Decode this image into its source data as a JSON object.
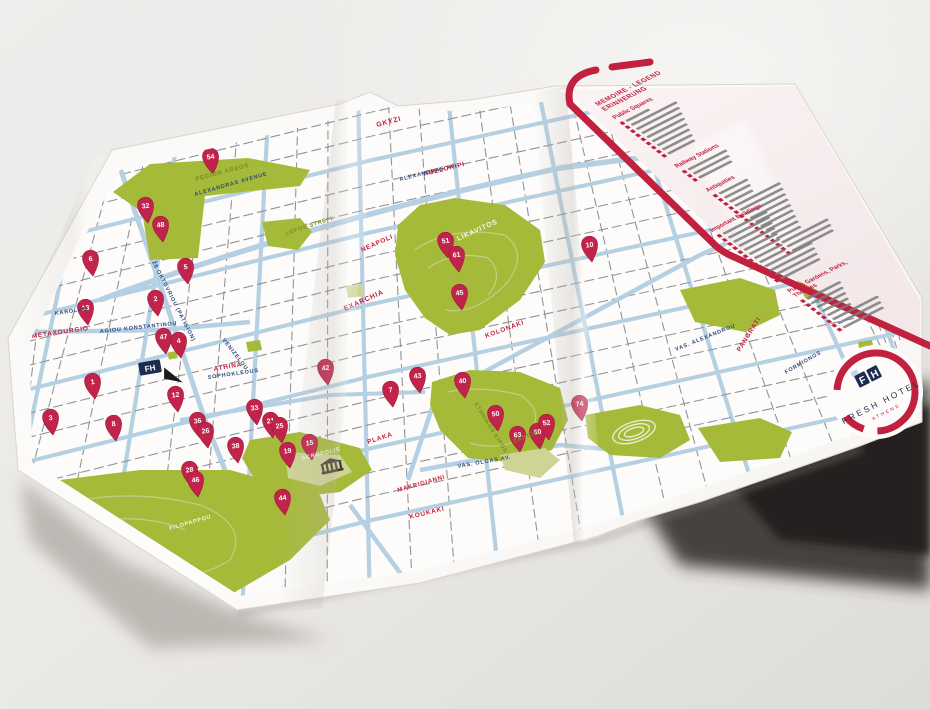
{
  "colors": {
    "accent_red": "#c2203f",
    "pin_red": "#c2234a",
    "park_green": "#a6ba3a",
    "park_light": "#cdd494",
    "road_blue": "#b5d0e2",
    "street_navy": "#2c4a7c",
    "paper": "#fcfbf9",
    "legend_pink": "#f7edee"
  },
  "logo": {
    "brand": "FRESH HOTEL",
    "city": "ATHENS",
    "monogram_f": "F",
    "monogram_h": "H"
  },
  "hotel_marker": {
    "monogram": "FH"
  },
  "legend": {
    "title1": "MEMOIRE - LEGEND",
    "title2": "ERINNERUNG",
    "sections": [
      {
        "header": "Public Squares",
        "items": 9
      },
      {
        "header": "Railway Stations",
        "items": 3
      },
      {
        "header": "Antiquities",
        "items": 15
      },
      {
        "header": "Important Buildings",
        "items": 12
      },
      {
        "header": "Public Gardens, Parks, Theatres",
        "items": 8
      }
    ]
  },
  "map": {
    "labels": [
      {
        "kind": "district",
        "text": "GKYZI",
        "x": 377,
        "y": 127,
        "r": -15,
        "s": 7
      },
      {
        "kind": "district",
        "text": "ABELOKIPI",
        "x": 424,
        "y": 176,
        "r": -14,
        "s": 6.5
      },
      {
        "kind": "district",
        "text": "NEAPOLI",
        "x": 362,
        "y": 252,
        "r": -24,
        "s": 6.5
      },
      {
        "kind": "district",
        "text": "EXARCHIA",
        "x": 345,
        "y": 311,
        "r": -24,
        "s": 7
      },
      {
        "kind": "district",
        "text": "METAXOURGIO",
        "x": 32,
        "y": 338,
        "r": -8,
        "s": 6.5
      },
      {
        "kind": "district",
        "text": "KOLONAKI",
        "x": 486,
        "y": 338,
        "r": -20,
        "s": 6.5
      },
      {
        "kind": "district",
        "text": "PLAKA",
        "x": 368,
        "y": 444,
        "r": -18,
        "s": 6.5
      },
      {
        "kind": "district",
        "text": "MAKRIGIANNI",
        "x": 398,
        "y": 492,
        "r": -16,
        "s": 6
      },
      {
        "kind": "district",
        "text": "KOUKAKI",
        "x": 410,
        "y": 519,
        "r": -14,
        "s": 6.5
      },
      {
        "kind": "district",
        "text": "PANGRATI",
        "x": 740,
        "y": 352,
        "r": -58,
        "s": 6.5
      },
      {
        "kind": "district",
        "text": "ATHINA",
        "x": 214,
        "y": 371,
        "r": -10,
        "s": 6.5
      },
      {
        "kind": "street",
        "text": "ALEXANDRAS AVENUE",
        "x": 195,
        "y": 196,
        "r": -16,
        "s": 5.5
      },
      {
        "kind": "street",
        "text": "ALEXANDRAS AV.",
        "x": 400,
        "y": 181,
        "r": -14,
        "s": 5.5
      },
      {
        "kind": "street",
        "text": "28 OKTOVRIOU (PATISION)",
        "x": 152,
        "y": 262,
        "r": 63,
        "s": 5.5
      },
      {
        "kind": "street",
        "text": "IOULIANOU",
        "x": 42,
        "y": 224,
        "r": -14,
        "s": 5.5
      },
      {
        "kind": "street",
        "text": "EPIROU",
        "x": 32,
        "y": 246,
        "r": -14,
        "s": 5.5
      },
      {
        "kind": "street",
        "text": "KAROLOU",
        "x": 55,
        "y": 315,
        "r": -8,
        "s": 5.5
      },
      {
        "kind": "street",
        "text": "AGIOU KONSTANTINOU",
        "x": 100,
        "y": 333,
        "r": -6,
        "s": 5.5
      },
      {
        "kind": "street",
        "text": "SOPHOKLEOUS",
        "x": 208,
        "y": 379,
        "r": -8,
        "s": 5.5
      },
      {
        "kind": "street",
        "text": "VENIZELOU",
        "x": 222,
        "y": 340,
        "r": 52,
        "s": 5.5
      },
      {
        "kind": "street",
        "text": "VAS. OLGAS AV.",
        "x": 458,
        "y": 468,
        "r": -10,
        "s": 5.5
      },
      {
        "kind": "street",
        "text": "VAS. ALEXANDROU",
        "x": 676,
        "y": 351,
        "r": -22,
        "s": 5.5
      },
      {
        "kind": "street",
        "text": "FORMIONOS",
        "x": 786,
        "y": 374,
        "r": -30,
        "s": 5.5
      },
      {
        "kind": "park",
        "text": "PEDION AREOS",
        "x": 196,
        "y": 181,
        "r": -15,
        "s": 6
      },
      {
        "kind": "park",
        "text": "LOFOS STREFI",
        "x": 286,
        "y": 235,
        "r": -18,
        "s": 5.5
      },
      {
        "kind": "parkwhite",
        "text": "LIKAVITOS",
        "x": 458,
        "y": 241,
        "r": -24,
        "s": 7
      },
      {
        "kind": "park",
        "text": "ETHNIKOS KIPOS",
        "x": 474,
        "y": 404,
        "r": 58,
        "s": 5.5
      },
      {
        "kind": "park",
        "text": "ZAPPIO",
        "x": 514,
        "y": 443,
        "r": -20,
        "s": 6
      },
      {
        "kind": "parkwhite",
        "text": "ACROPOLIS",
        "x": 302,
        "y": 460,
        "r": -14,
        "s": 5.5
      },
      {
        "kind": "parkwhite",
        "text": "FILOPAPPOU",
        "x": 170,
        "y": 530,
        "r": -16,
        "s": 5.5
      }
    ],
    "pins": [
      {
        "n": "54",
        "x": 213,
        "y": 174
      },
      {
        "n": "32",
        "x": 148,
        "y": 223
      },
      {
        "n": "48",
        "x": 163,
        "y": 242
      },
      {
        "n": "6",
        "x": 93,
        "y": 276
      },
      {
        "n": "5",
        "x": 188,
        "y": 284
      },
      {
        "n": "2",
        "x": 158,
        "y": 316
      },
      {
        "n": "9",
        "x": 22,
        "y": 317
      },
      {
        "n": "13",
        "x": 88,
        "y": 325
      },
      {
        "n": "47",
        "x": 166,
        "y": 354
      },
      {
        "n": "4",
        "x": 181,
        "y": 358
      },
      {
        "n": "1",
        "x": 95,
        "y": 399
      },
      {
        "n": "3",
        "x": 53,
        "y": 435
      },
      {
        "n": "8",
        "x": 116,
        "y": 441
      },
      {
        "n": "51",
        "x": 448,
        "y": 258
      },
      {
        "n": "61",
        "x": 459,
        "y": 272
      },
      {
        "n": "45",
        "x": 462,
        "y": 310
      },
      {
        "n": "10",
        "x": 592,
        "y": 262
      },
      {
        "n": "42",
        "x": 328,
        "y": 385
      },
      {
        "n": "7",
        "x": 393,
        "y": 407
      },
      {
        "n": "12",
        "x": 178,
        "y": 412
      },
      {
        "n": "33",
        "x": 257,
        "y": 425
      },
      {
        "n": "21",
        "x": 273,
        "y": 438
      },
      {
        "n": "38",
        "x": 238,
        "y": 463
      },
      {
        "n": "25",
        "x": 282,
        "y": 443
      },
      {
        "n": "36",
        "x": 200,
        "y": 438
      },
      {
        "n": "26",
        "x": 208,
        "y": 448
      },
      {
        "n": "19",
        "x": 290,
        "y": 468
      },
      {
        "n": "15",
        "x": 312,
        "y": 460
      },
      {
        "n": "28",
        "x": 192,
        "y": 487
      },
      {
        "n": "46",
        "x": 198,
        "y": 497
      },
      {
        "n": "44",
        "x": 285,
        "y": 515
      },
      {
        "n": "43",
        "x": 420,
        "y": 393
      },
      {
        "n": "40",
        "x": 465,
        "y": 398
      },
      {
        "n": "50",
        "x": 498,
        "y": 431
      },
      {
        "n": "63",
        "x": 520,
        "y": 452
      },
      {
        "n": "60",
        "x": 540,
        "y": 449
      },
      {
        "n": "52",
        "x": 549,
        "y": 440
      },
      {
        "n": "74",
        "x": 582,
        "y": 421
      }
    ]
  }
}
